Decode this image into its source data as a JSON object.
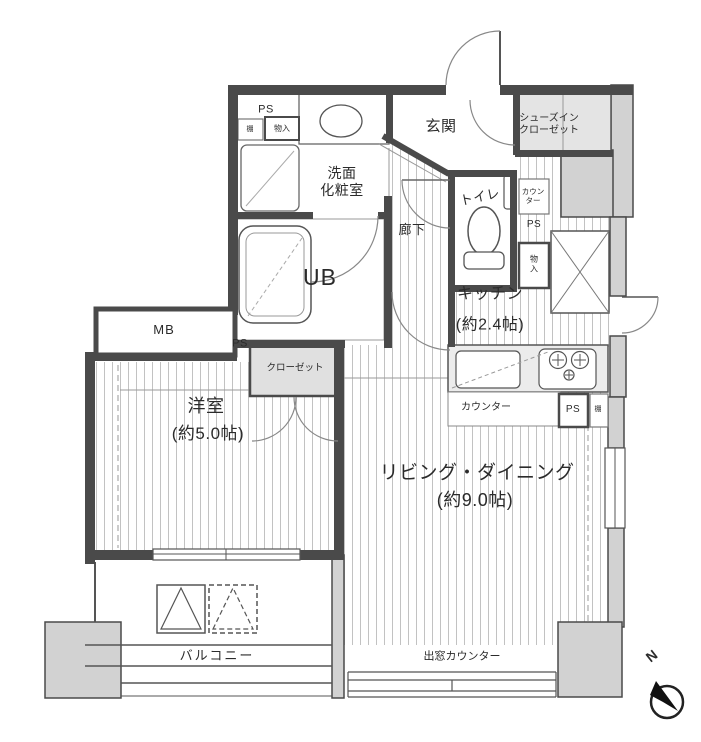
{
  "plan_title": "apartment-floor-plan",
  "labels": {
    "entrance": "玄関",
    "shoe_closet": "シューズイン\nクローゼット",
    "washroom": "洗面\n化粧室",
    "toilet": "トイレ",
    "unit_bath": "UB",
    "corridor": "廊下",
    "kitchen": "キッチン",
    "kitchen_size": "(約2.4帖)",
    "counter_vertical": "カウン\nター",
    "ps": "PS",
    "shelf": "棚",
    "storage": "物入",
    "storage_vertical": "物\n入",
    "mb": "MB",
    "closet": "クローゼット",
    "western_room": "洋室",
    "western_room_size": "(約5.0帖)",
    "living_dining": "リビング・ダイニング",
    "living_dining_size": "(約9.0帖)",
    "counter": "カウンター",
    "bay_window_counter": "出窓カウンター",
    "balcony": "バルコニー",
    "north": "N"
  },
  "colors": {
    "wall": "#4a4a4a",
    "outer_wall_fill": "#d2d2d2",
    "shaded_area": "#e4e4e4",
    "floor_hatch": "#c2c2c2",
    "background": "#ffffff",
    "text": "#2b2b2b"
  }
}
